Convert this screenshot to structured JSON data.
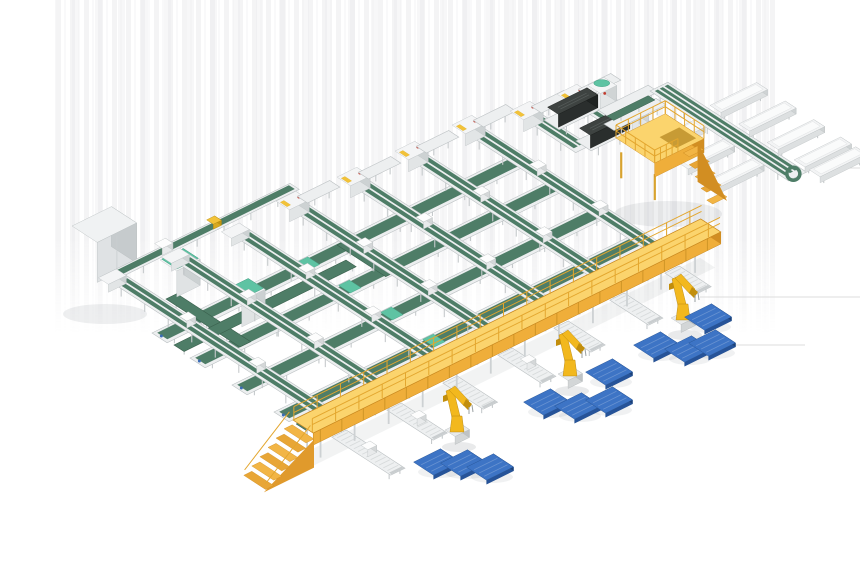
{
  "canvas": {
    "width": 860,
    "height": 580,
    "background": "#ffffff"
  },
  "iso": {
    "u": [
      0.896,
      -0.442
    ],
    "v": [
      0.84,
      0.545
    ]
  },
  "palette": {
    "frameLight": "#edeff0",
    "frameStroke": "#bcc1c3",
    "frameSide": "#d9dcdd",
    "leg": "#c6cacc",
    "beltGreen": "#4e7d67",
    "beltGreenDark": "#3a604d",
    "mint": "#5ec3a3",
    "mintDark": "#41a184",
    "dark": "#3e4341",
    "darkSide": "#2a2e2d",
    "darkSide2": "#1f2322",
    "yellowTop": "#fbd46d",
    "yellowSide": "#efae3a",
    "yellowSideDark": "#d28e22",
    "yellowStroke": "#c9881e",
    "railYellow": "#e3a62e",
    "stepA": "#f2b545",
    "stepB": "#e8a636",
    "robotYellow": "#f2b81e",
    "robotShade": "#c28e0c",
    "pedestal": "#e8eaeb",
    "palletTop": "#3d74c5",
    "palletSide": "#265399",
    "palletDark": "#1c4076",
    "palletStroke": "#24508f",
    "white": "#f6f7f8",
    "shadow": "rgba(70,80,90,0.09)",
    "band1": "#ebebed",
    "band2": "#f4f4f6",
    "floorLine": "#dcdcdc",
    "cabinetTop": "#f0f2f3",
    "cabinetFront": "#dfe2e4",
    "cabinetRight": "#c6cbcd",
    "accentYellow": "#f2c238",
    "accentRed": "#c23b2e",
    "accentBlue": "#3a6bb5"
  },
  "scene": {
    "bands": {
      "x": 55,
      "y": 0,
      "w": 720,
      "h": 335
    },
    "floor_lines": [
      [
        700,
        297,
        860,
        297
      ],
      [
        677,
        345,
        805,
        345
      ],
      [
        808,
        168,
        860,
        168
      ]
    ],
    "cabinet": {
      "a": [
        72,
        266
      ],
      "lu": 44,
      "lv": 30,
      "h": 40
    },
    "infeed": {
      "a": [
        100,
        286
      ],
      "lu": 212,
      "w": 11,
      "clip_u": 118
    },
    "loop_arms": [
      {
        "a": [
          166,
          304
        ],
        "lu": 12,
        "lv": 88
      },
      {
        "a": [
          174,
          350
        ],
        "lu": 192,
        "lv": 12
      },
      {
        "a": [
          337,
          250
        ],
        "lu": 12,
        "lv": 58
      }
    ],
    "mint_machines": [
      {
        "a": [
          160,
          286
        ]
      },
      {
        "a": [
          225,
          316
        ]
      }
    ],
    "cross_conveyors": [
      {
        "a": [
          296,
          430
        ],
        "lu": 368,
        "w": 12,
        "thin": true
      },
      {
        "a": [
          274,
          418
        ],
        "lu": 410,
        "w": 18,
        "thin": false
      },
      {
        "a": [
          232,
          391
        ],
        "lu": 410,
        "w": 18,
        "thin": false
      },
      {
        "a": [
          190,
          364
        ],
        "lu": 410,
        "w": 18,
        "thin": false
      },
      {
        "a": [
          152,
          339
        ],
        "lu": 400,
        "w": 18,
        "thin": false
      }
    ],
    "lanes": [
      {
        "top": [
          111,
          292
        ],
        "len": 260,
        "station": false
      },
      {
        "top": [
          174,
          271
        ],
        "len": 250,
        "station": false
      },
      {
        "top": [
          234,
          246
        ],
        "len": 245,
        "station": false
      },
      {
        "top": [
          293,
          221
        ],
        "len": 240,
        "station": true
      },
      {
        "top": [
          354,
          197
        ],
        "len": 235,
        "station": true
      },
      {
        "top": [
          412,
          171
        ],
        "len": 232,
        "station": true
      },
      {
        "top": [
          469,
          145
        ],
        "len": 230,
        "station": true
      }
    ],
    "stubs": [
      {
        "top": [
          527,
          131
        ],
        "len": 58,
        "station": true
      },
      {
        "top": [
          574,
          114
        ],
        "len": 50,
        "station": true
      }
    ],
    "dark_machines": [
      {
        "a": [
          544,
          130
        ]
      },
      {
        "a": [
          576,
          151
        ]
      }
    ],
    "top_tables": [
      {
        "a": [
          598,
          118
        ],
        "lu": 56,
        "w": 12
      },
      {
        "a": [
          604,
          132
        ],
        "lu": 58,
        "w": 12
      }
    ],
    "connector": {
      "a": [
        607,
        122
      ],
      "lu": 46,
      "w": 8
    },
    "spine": {
      "a": [
        650,
        99
      ],
      "w": 20,
      "len": 165
    },
    "chutes": {
      "left_v": [
        55,
        90,
        125
      ],
      "right_v": [
        48,
        82,
        116,
        148,
        166
      ],
      "len": 52,
      "w": 13
    },
    "platform": {
      "a": [
        616,
        178
      ],
      "lu": 55,
      "lv": 46,
      "legh": 26,
      "deck": 14
    },
    "outfeeds": [
      {
        "j": [
          329,
          434
        ],
        "len": 70,
        "boxes": true
      },
      {
        "j": [
          384,
          407
        ],
        "len": 55,
        "boxes": true
      },
      {
        "j": [
          440,
          380
        ],
        "len": 48,
        "boxes": false
      },
      {
        "j": [
          495,
          352
        ],
        "len": 52,
        "boxes": true
      },
      {
        "j": [
          551,
          325
        ],
        "len": 44,
        "boxes": false
      },
      {
        "j": [
          607,
          297
        ],
        "len": 46,
        "boxes": false
      },
      {
        "j": [
          662,
          270
        ],
        "len": 38,
        "boxes": false
      }
    ],
    "gantry": {
      "a": [
        293,
        452
      ],
      "lu": 455,
      "lv": 24,
      "deck": 32,
      "under": 20,
      "rail": 14,
      "stair_steps": 6
    },
    "robots": [
      {
        "base": [
          457,
          440
        ]
      },
      {
        "base": [
          570,
          384
        ]
      },
      {
        "base": [
          683,
          328
        ]
      }
    ],
    "pallets": {
      "size": {
        "lu": 30,
        "lv": 24,
        "t": 4
      },
      "centers": [
        [
          437,
          466
        ],
        [
          464,
          467
        ],
        [
          490,
          471
        ],
        [
          547,
          406
        ],
        [
          578,
          410
        ],
        [
          609,
          404
        ],
        [
          609,
          376
        ],
        [
          657,
          349
        ],
        [
          688,
          353
        ],
        [
          712,
          347
        ],
        [
          708,
          321
        ]
      ]
    }
  }
}
